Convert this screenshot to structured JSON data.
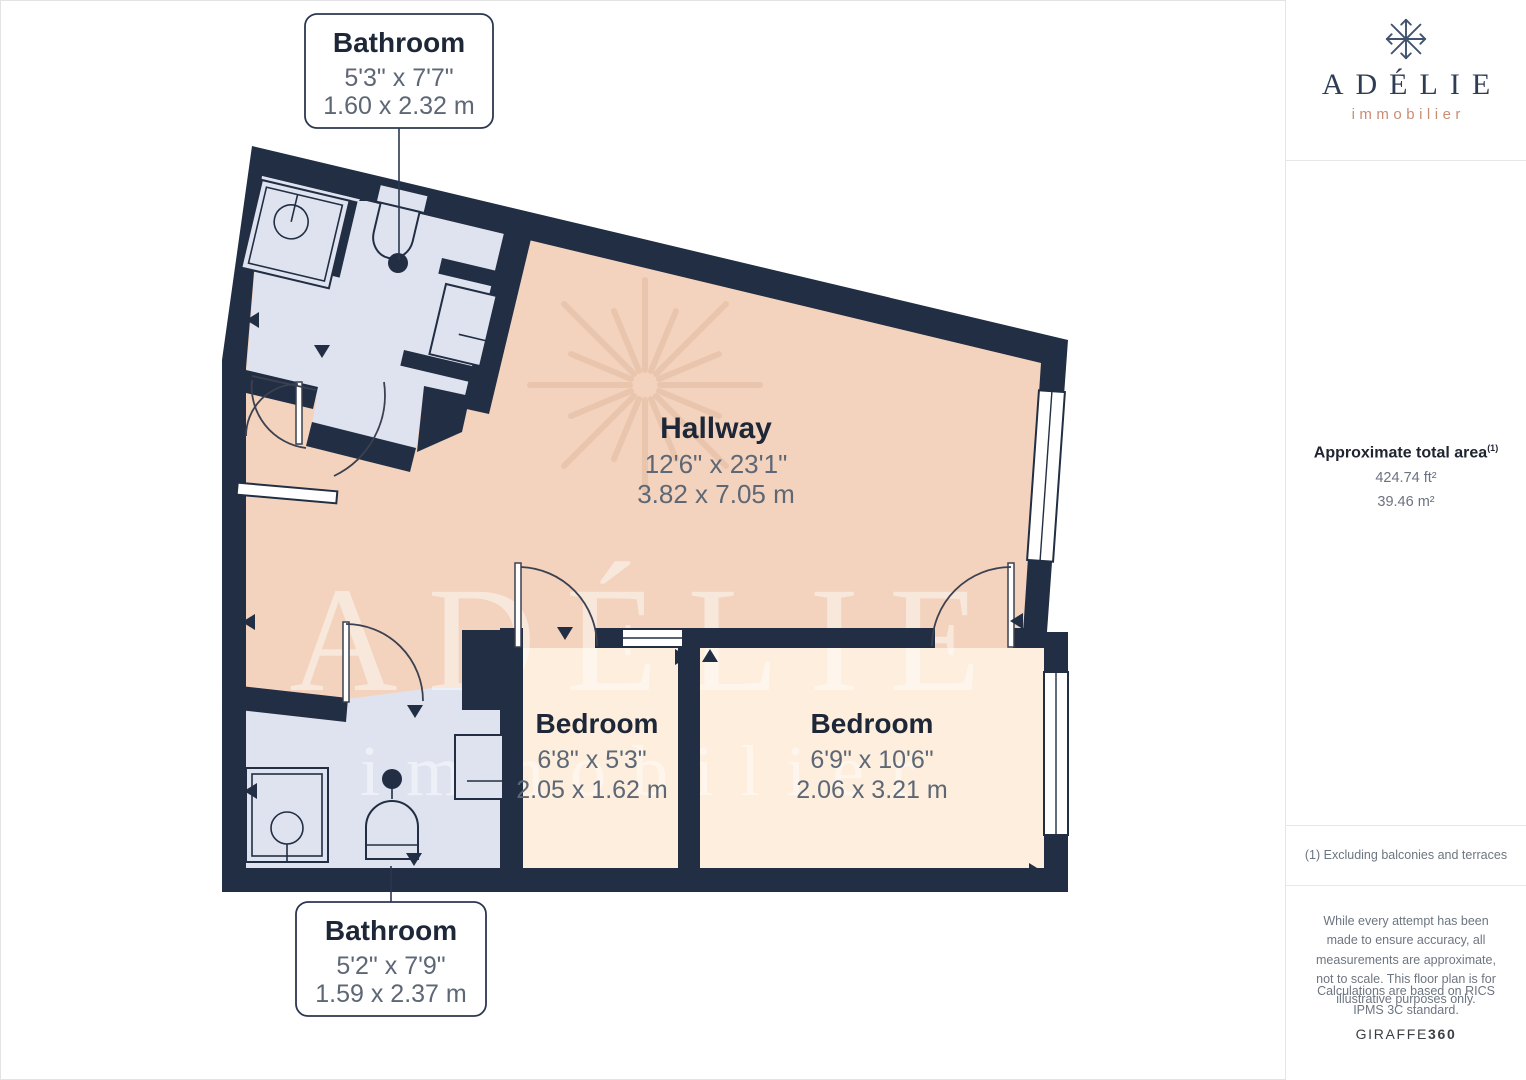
{
  "plan": {
    "rooms": [
      {
        "name": "Bathroom",
        "imperial": "5'3\" x 7'7\"",
        "metric": "1.60 x 2.32 m"
      },
      {
        "name": "Hallway",
        "imperial": "12'6\" x 23'1\"",
        "metric": "3.82 x 7.05 m"
      },
      {
        "name": "Bedroom",
        "imperial": "6'8\" x 5'3\"",
        "metric": "2.05 x 1.62 m"
      },
      {
        "name": "Bedroom",
        "imperial": "6'9\" x 10'6\"",
        "metric": "2.06 x 3.21 m"
      },
      {
        "name": "Bathroom",
        "imperial": "5'2\" x 7'9\"",
        "metric": "1.59 x 2.37 m"
      }
    ],
    "watermark": {
      "line1": "ADÉLIE",
      "line2": "immobilier"
    }
  },
  "sidebar": {
    "logo": {
      "name": "ADÉLIE",
      "tagline": "immobilier"
    },
    "area": {
      "title": "Approximate total area",
      "superscript": "(1)",
      "imperial": "424.74 ft²",
      "metric": "39.46 m²"
    },
    "footnote": "(1) Excluding balconies and terraces",
    "disclaimers": {
      "accuracy": "While every attempt has been made to ensure accuracy, all measurements are approximate, not to scale. This floor plan is for illustrative purposes only.",
      "standard": "Calculations are based on RICS IPMS 3C standard."
    },
    "brand": {
      "name": "GIRAFFE",
      "suffix": "360"
    }
  },
  "colors": {
    "wall": "#212e43",
    "hallway": "#f3d3bd",
    "bedroom": "#fdeedd",
    "bathroom": "#dfe3f0",
    "navy-text": "#1d2737",
    "dim-text": "#5d6775",
    "accent": "#c98d74",
    "divider": "#e7e7ea"
  }
}
